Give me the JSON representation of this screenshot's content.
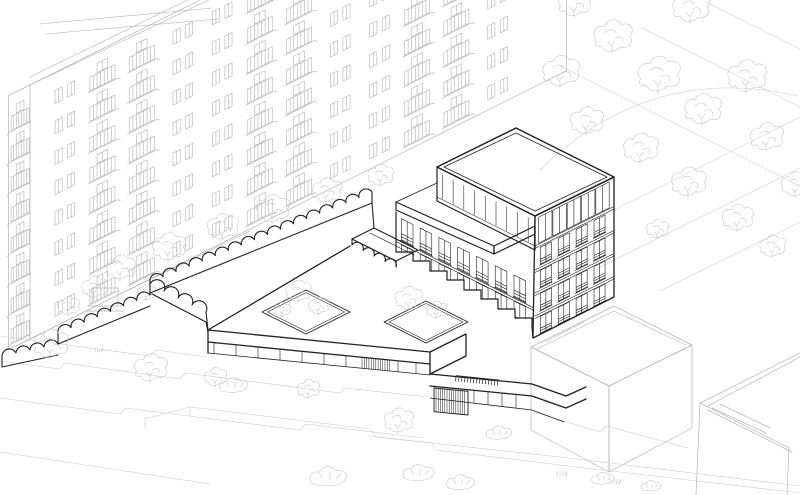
{
  "document": {
    "kind": "architectural axonometric line drawing",
    "subject": "Proposed infill building with stippled green roof, courtyard podium and scalloped garden wall, set between a balconied housing slab, a tree park and neighbouring roofs",
    "visible_text": "no legible text; only a tiny illegible signage strip on the podium fascia"
  },
  "palette": {
    "background": "#ffffff",
    "hero_ink": "#1f1f1f",
    "context_ink": "#b3b3b3",
    "vegetation_ink": "#c6c6c6",
    "terrain_ink": "#cccccc",
    "stipple_ink": "#999999"
  },
  "scene": {
    "hero_building": {
      "label": "proposed building",
      "podium_storeys": 1,
      "tower_storeys": 5,
      "roof": "stippled green roof with parapet",
      "roof_courtyards": 2,
      "features": [
        "scalloped garden wall",
        "scalloped entrance canopy",
        "louvred shopfront panels",
        "illegible signage strip",
        "setback roof terrace"
      ]
    },
    "context": {
      "residential_slab": {
        "label": "existing housing slab with balconies",
        "position": "upper left",
        "storeys_visible": 8,
        "bays": 12
      },
      "park": {
        "label": "tree park and paved plaza",
        "position": "upper right",
        "trees": 15,
        "paths": "diagonal paving grid with curved path"
      },
      "neighbouring_buildings": {
        "label": "neighbouring flat roofs",
        "position": "lower right",
        "count": 2
      },
      "street": {
        "label": "terraced street with retaining walls",
        "position": "lower left",
        "street_trees": 5,
        "bushes": 7
      }
    }
  }
}
